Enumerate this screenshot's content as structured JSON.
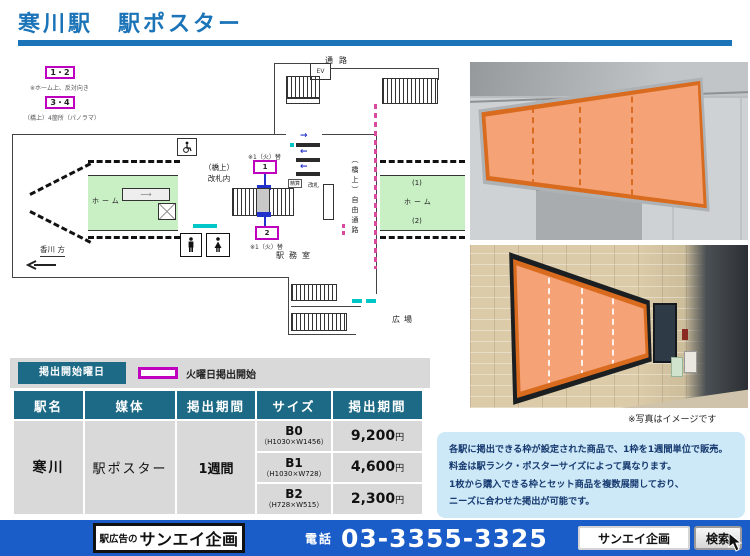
{
  "title": "寒川駅　駅ポスター",
  "map": {
    "legend_boxes": [
      {
        "label": "1・2",
        "note": "※ホーム上、反対向き"
      },
      {
        "label": "3・4",
        "note": "（橋上）4箇所（パノラマ）"
      }
    ],
    "labels": {
      "passage": "通路",
      "elevator": "EV",
      "elevator2": "EV",
      "concourse_line1": "（橋上）",
      "concourse_line2": "改札内",
      "free_passage": "（橋上）自由通路",
      "station_office": "駅務室",
      "platform_left": "ホーム",
      "platform_right": "ホーム",
      "platform_no1": "(1)",
      "platform_no2": "(2)",
      "direction": "香川 方",
      "plaza": "広場",
      "fare_adjust": "精算",
      "gate": "改札",
      "frame1": "1",
      "frame2": "2",
      "frame1_note": "※1（火）替",
      "frame2_note": "※1（火）替"
    }
  },
  "legend": {
    "box_label": "掲出開始曜日",
    "desc": "火曜日掲出開始"
  },
  "table": {
    "headers": [
      "駅名",
      "媒体",
      "掲出期間",
      "サイズ",
      "掲出期間"
    ],
    "station": "寒川",
    "media": "駅ポスター",
    "period": "1週間",
    "rows": [
      {
        "size": "B0",
        "dims": "（H1030×W1456）",
        "price": "9,200",
        "unit": "円"
      },
      {
        "size": "B1",
        "dims": "（H1030×W728）",
        "price": "4,600",
        "unit": "円"
      },
      {
        "size": "B2",
        "dims": "（H728×W515）",
        "price": "2,300",
        "unit": "円"
      }
    ]
  },
  "photos": {
    "caption": "※写真はイメージです"
  },
  "info_box": {
    "lines": [
      "各駅に掲出できる枠が設定された商品で、1枠を1週間単位で販売。",
      "料金は駅ランク・ポスターサイズによって異なります。",
      "1枚から購入できる枠とセット商品を複数展開しており、",
      "ニーズに合わせた掲出が可能です。"
    ]
  },
  "footer": {
    "company_prefix": "駅広告の",
    "company": "サンエイ企画",
    "tel_label": "電話",
    "tel": "03-3355-3325",
    "search_text": "サンエイ企画",
    "search_button": "検索"
  },
  "colors": {
    "accent_blue": "#1b74b8",
    "table_header_teal": "#1c6a86",
    "magenta": "#bf00bf",
    "poster_orange": "#f4a276",
    "poster_orange_border": "#d96b1f",
    "platform_green": "#c9efc5",
    "footer_blue": "#1a5cc8",
    "info_bg": "#cde9f8"
  }
}
